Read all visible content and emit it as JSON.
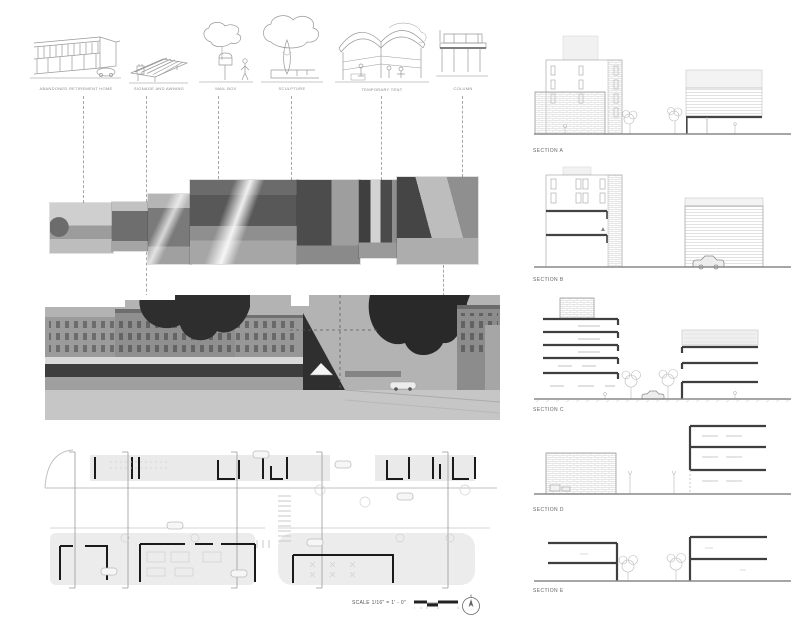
{
  "palette": {
    "background": "#ffffff",
    "line_dark": "#3f3f3f",
    "line_mid": "#8a8a8a",
    "line_light": "#cccccc",
    "fill_light": "#eaeaea",
    "photo_dark": "#4c4c4c",
    "photo_sky": "#b3b3b3"
  },
  "sketch_row": {
    "items": [
      {
        "label": "ABANDONED RETIREMENT HOME"
      },
      {
        "label": "SIGNAGE AND AWNING"
      },
      {
        "label": "MAIL BOX"
      },
      {
        "label": "SCULPTURE"
      },
      {
        "label": "TEMPORARY TENT"
      },
      {
        "label": "COLUMN"
      }
    ]
  },
  "sections": {
    "items": [
      {
        "label": "SECTION A"
      },
      {
        "label": "SECTION B"
      },
      {
        "label": "SECTION C"
      },
      {
        "label": "SECTION D"
      },
      {
        "label": "SECTION E"
      }
    ]
  },
  "plan": {
    "scale_label": "SCALE 1/16\" = 1' - 0\""
  }
}
